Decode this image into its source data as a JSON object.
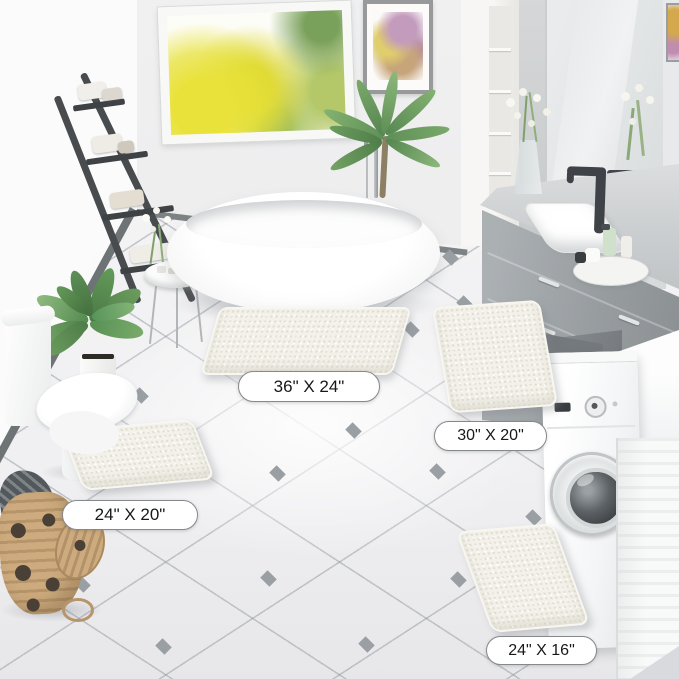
{
  "labels": [
    {
      "name": "large",
      "text": "36\" X 24\""
    },
    {
      "name": "runner",
      "text": "30\" X 20\""
    },
    {
      "name": "contour",
      "text": "24\" X 20\""
    },
    {
      "name": "small",
      "text": "24\" X 16\""
    }
  ],
  "colors": {
    "mat_ivory": "#f3f1e9",
    "wall_gray": "#ebebec",
    "floor_white": "#f4f4f5",
    "tile_diamond_gray": "#999fa3",
    "cabinet_gray": "#989da0",
    "ladder_charcoal": "#484c4f",
    "faucet_black": "#3f4347",
    "basket_tan": "#c09f73",
    "window_foliage_yellow": "#e9e23a"
  }
}
